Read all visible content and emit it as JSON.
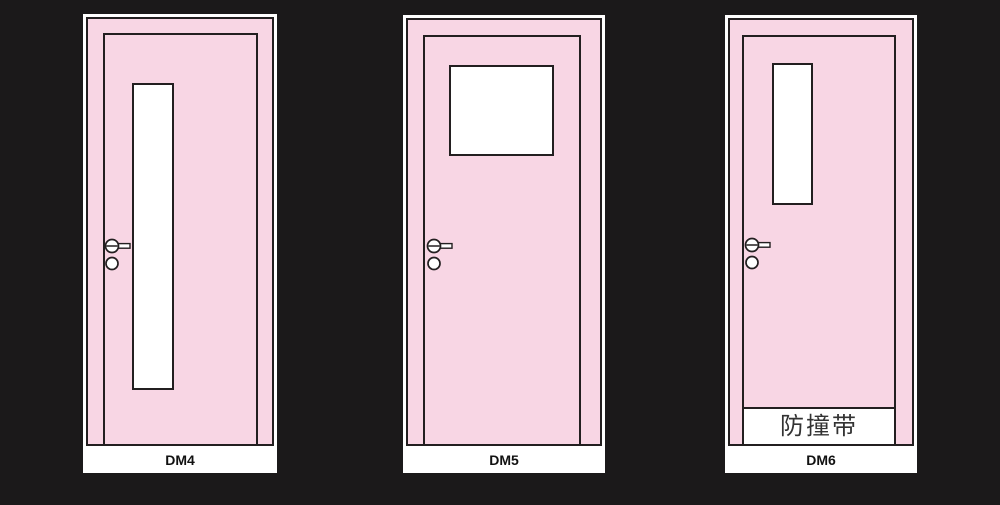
{
  "page": {
    "description_labels": [
      "DM4",
      "DM5",
      "DM6"
    ]
  },
  "colors": {
    "bg": "#1b191a",
    "door-pink": "#f8d6e4",
    "outline": "#231f20",
    "glass": "#ffffff",
    "card": "#ffffff",
    "label-text": "#111111",
    "bumper-text": "#333333"
  },
  "doors": [
    {
      "label": "DM4",
      "window_style": "tall-narrow-vision-strip"
    },
    {
      "label": "DM5",
      "window_style": "square-vision-panel"
    },
    {
      "label": "DM6",
      "window_style": "short-narrow-vision-strip",
      "bumper_text": "防撞带"
    }
  ]
}
